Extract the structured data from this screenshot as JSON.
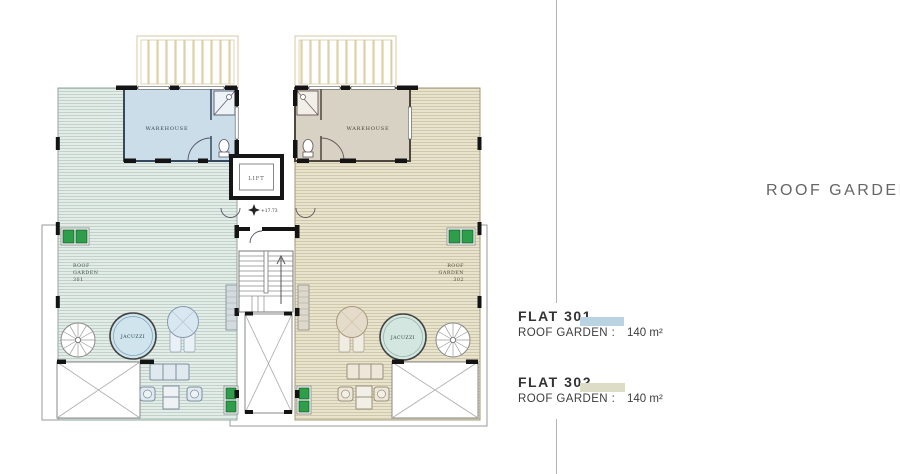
{
  "panel": {
    "title": "ROOF GARDEN",
    "legend": [
      {
        "flat": "FLAT 301",
        "row_label": "ROOF GARDEN :",
        "area": "140 m²",
        "swatch": "#b9d3e2"
      },
      {
        "flat": "FLAT 302",
        "row_label": "ROOF GARDEN :",
        "area": "140 m²",
        "swatch": "#dddcc7"
      }
    ]
  },
  "plan": {
    "core": {
      "lift": "LIFT",
      "level": "+17.73"
    },
    "flat301": {
      "warehouse": "WAREHOUSE",
      "jacuzzi": "JACUZZI",
      "garden": [
        "ROOF",
        "GARDEN",
        "301"
      ]
    },
    "flat302": {
      "warehouse": "WAREHOUSE",
      "jacuzzi": "JACUZZI",
      "garden": [
        "ROOF",
        "GARDEN",
        "302"
      ]
    }
  },
  "colors": {
    "garden301_bg": "#e3ece7",
    "garden301_line": "#b7ccc4",
    "garden302_bg": "#e7e3cd",
    "garden302_line": "#c9c2a3",
    "warehouse301": "#cbdde9",
    "warehouse302": "#d8d2c4",
    "jacuzzi301": "#cfe4ed",
    "jacuzzi302": "#d3e6df",
    "pergola_line": "#ddd1a8",
    "ac_green": "#2f9e4a",
    "divider": "#b3b3b3",
    "title_text": "#666666"
  }
}
